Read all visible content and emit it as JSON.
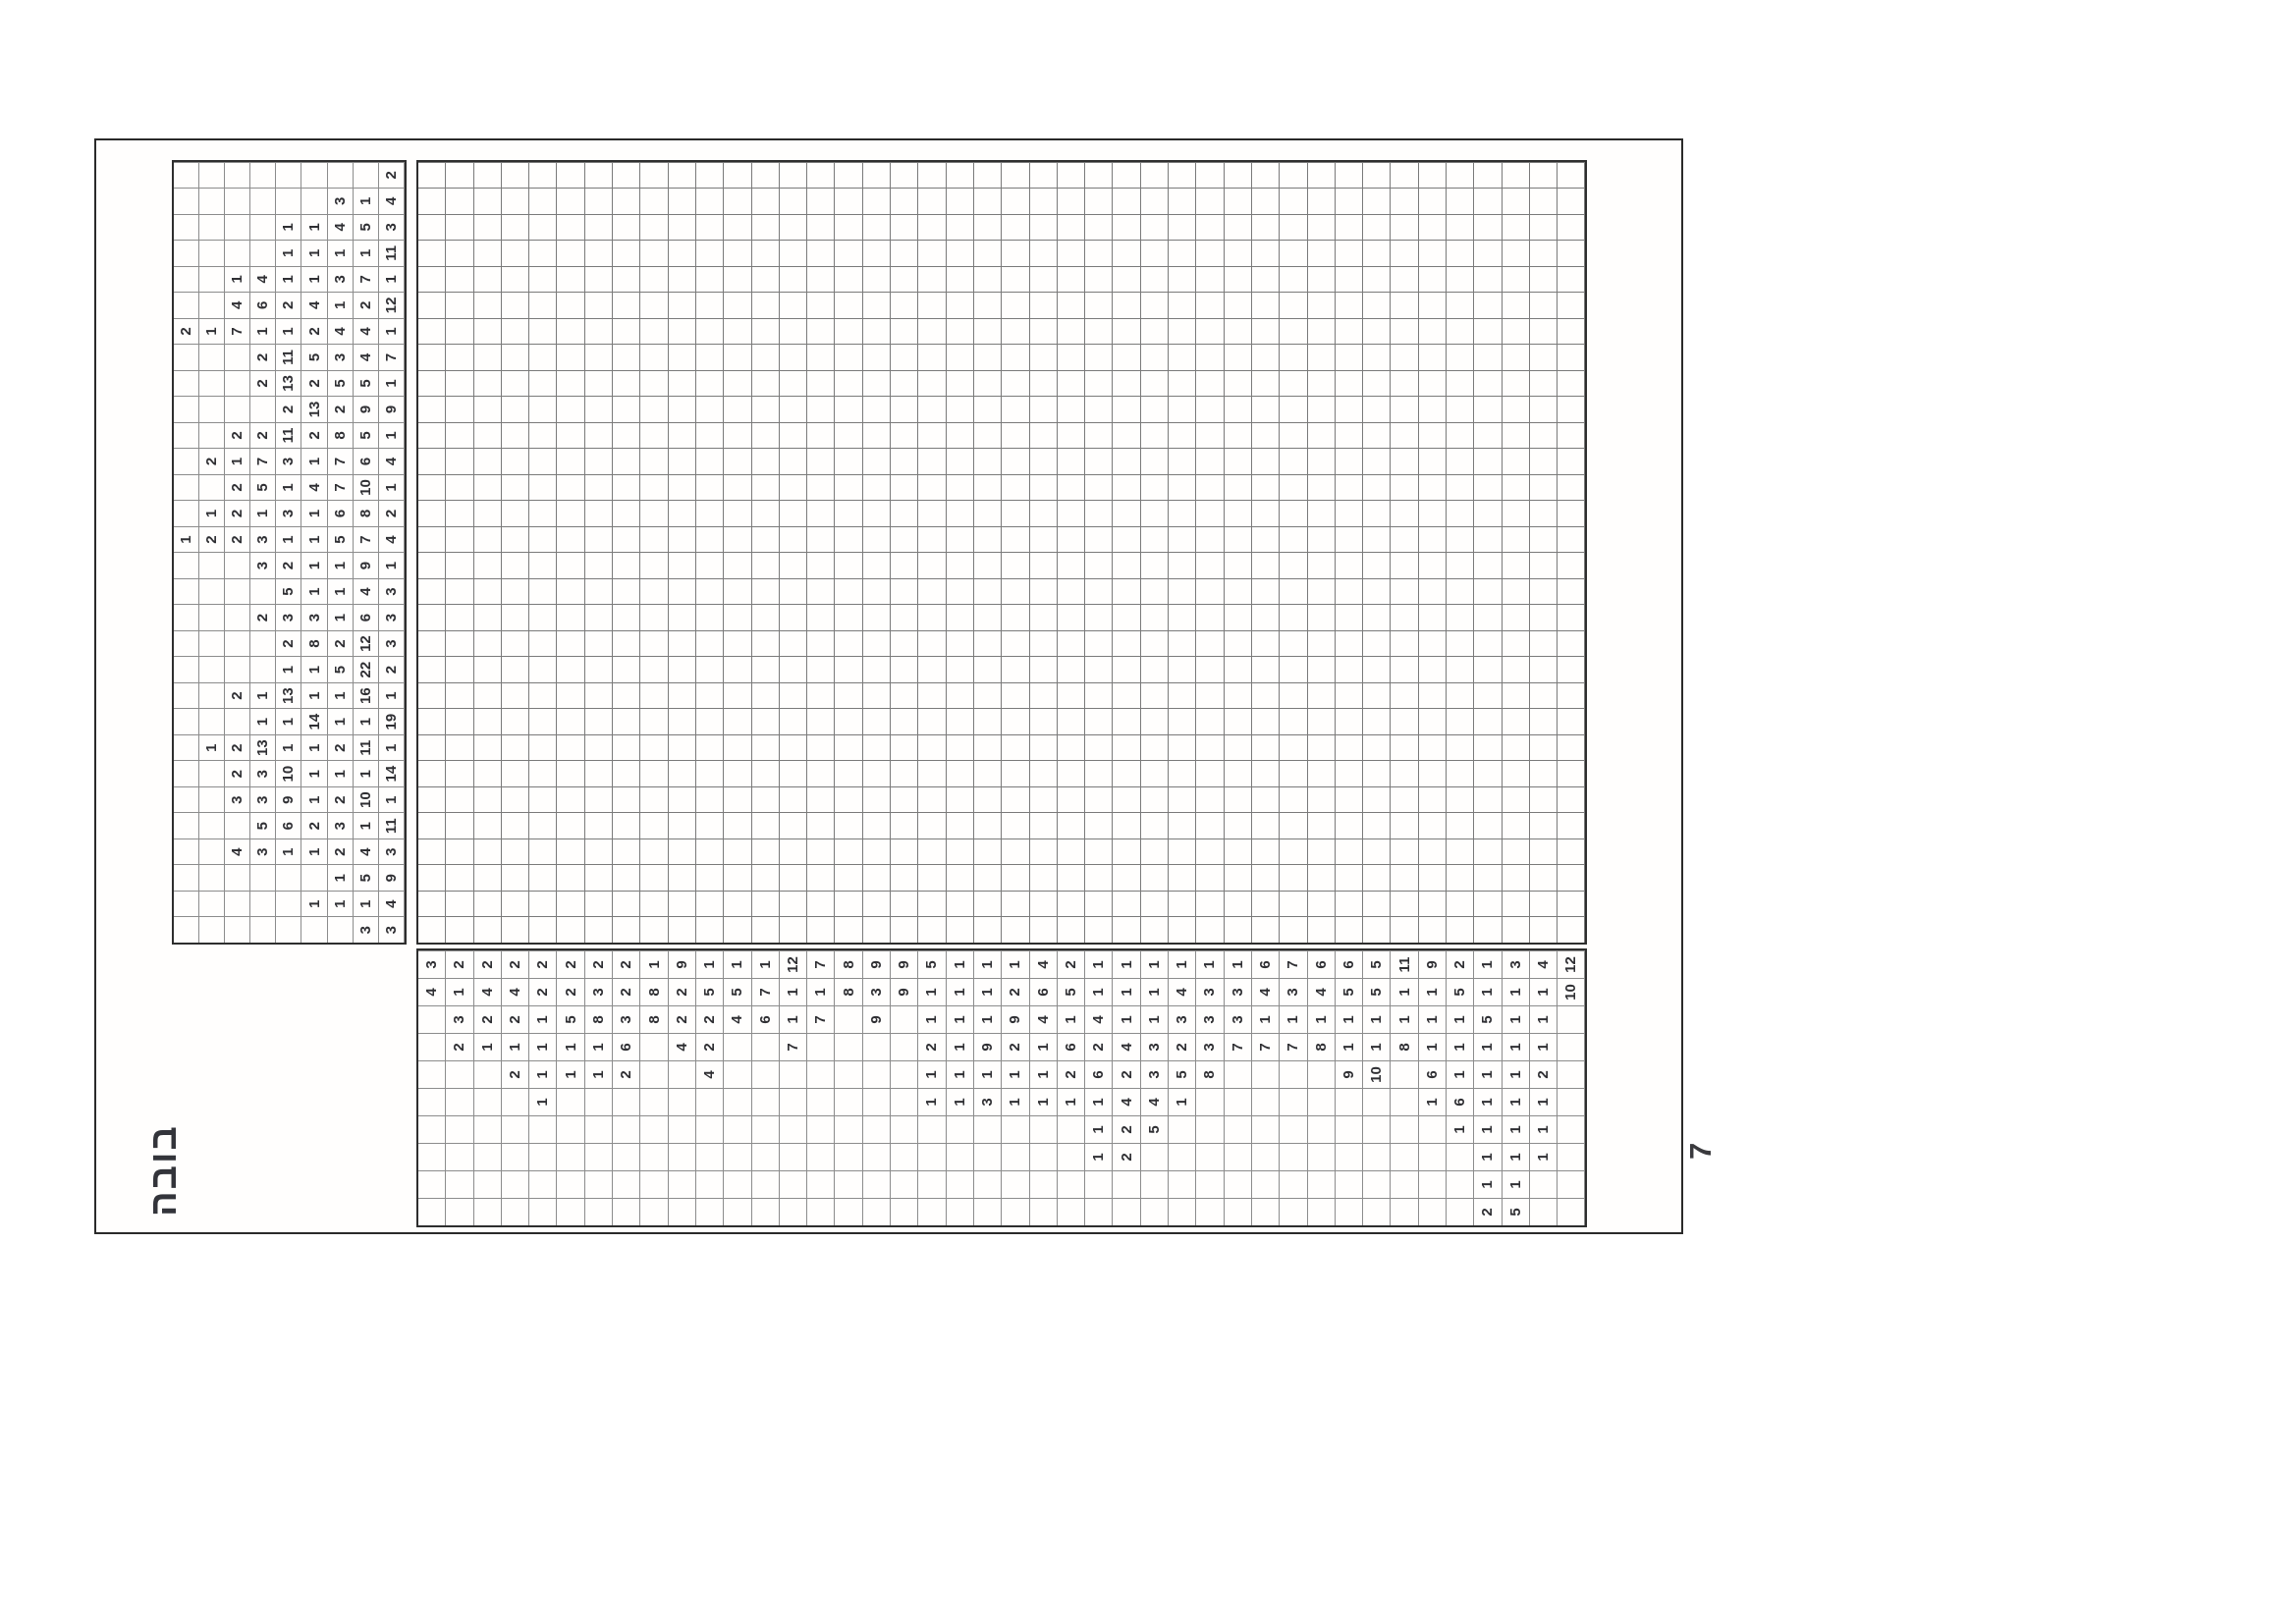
{
  "page": {
    "title": "בובה",
    "page_number": "7"
  },
  "puzzle": {
    "type": "nonogram",
    "grid_columns": 30,
    "grid_rows": 42,
    "column_clue_depth": 9,
    "row_clue_depth": 10,
    "column_clues": [
      [
        3,
        3
      ],
      [
        1,
        1,
        1,
        4
      ],
      [
        1,
        5,
        9
      ],
      [
        4,
        3,
        1,
        1,
        2,
        4,
        3
      ],
      [
        5,
        6,
        2,
        3,
        1,
        11
      ],
      [
        3,
        3,
        9,
        1,
        2,
        10,
        1
      ],
      [
        2,
        3,
        10,
        1,
        1,
        1,
        14
      ],
      [
        1,
        2,
        13,
        1,
        1,
        2,
        11,
        1
      ],
      [
        1,
        1,
        14,
        1,
        1,
        19
      ],
      [
        2,
        1,
        13,
        1,
        1,
        16,
        1
      ],
      [
        1,
        1,
        5,
        22,
        2
      ],
      [
        2,
        8,
        2,
        12,
        3
      ],
      [
        2,
        3,
        3,
        1,
        6,
        3
      ],
      [
        5,
        1,
        1,
        4,
        3
      ],
      [
        3,
        2,
        1,
        1,
        9,
        1
      ],
      [
        1,
        2,
        2,
        3,
        1,
        1,
        5,
        7,
        4
      ],
      [
        1,
        2,
        1,
        3,
        1,
        6,
        8,
        2
      ],
      [
        2,
        5,
        1,
        4,
        7,
        10,
        1
      ],
      [
        2,
        1,
        7,
        3,
        1,
        7,
        6,
        4
      ],
      [
        2,
        2,
        11,
        2,
        8,
        5,
        1
      ],
      [
        2,
        13,
        2,
        9,
        9
      ],
      [
        2,
        13,
        2,
        5,
        5,
        1
      ],
      [
        2,
        11,
        5,
        3,
        4,
        7
      ],
      [
        2,
        1,
        7,
        1,
        1,
        2,
        4,
        4,
        1
      ],
      [
        4,
        6,
        2,
        4,
        1,
        2,
        12
      ],
      [
        1,
        4,
        1,
        1,
        3,
        7,
        1
      ],
      [
        1,
        1,
        1,
        1,
        11
      ],
      [
        1,
        1,
        4,
        5,
        3
      ],
      [
        3,
        1,
        4
      ],
      [
        2
      ]
    ],
    "row_clues": [
      [
        4,
        3
      ],
      [
        2,
        3,
        1,
        2
      ],
      [
        1,
        2,
        4,
        2
      ],
      [
        2,
        1,
        2,
        4,
        2
      ],
      [
        1,
        1,
        1,
        1,
        2,
        2
      ],
      [
        1,
        1,
        5,
        2,
        2
      ],
      [
        1,
        1,
        8,
        3,
        2
      ],
      [
        2,
        6,
        3,
        2,
        2
      ],
      [
        8,
        8,
        1
      ],
      [
        4,
        2,
        2,
        9
      ],
      [
        4,
        2,
        2,
        5,
        1
      ],
      [
        4,
        5,
        1
      ],
      [
        6,
        7,
        1
      ],
      [
        7,
        1,
        1,
        12
      ],
      [
        7,
        1,
        7
      ],
      [
        8,
        8
      ],
      [
        9,
        3,
        9
      ],
      [
        9,
        9
      ],
      [
        1,
        1,
        2,
        1,
        1,
        5
      ],
      [
        1,
        1,
        1,
        1,
        1,
        1
      ],
      [
        3,
        1,
        9,
        1,
        1,
        1
      ],
      [
        1,
        1,
        2,
        9,
        2,
        1
      ],
      [
        1,
        1,
        1,
        4,
        6,
        4
      ],
      [
        1,
        2,
        6,
        1,
        5,
        2
      ],
      [
        1,
        1,
        1,
        6,
        2,
        4,
        1,
        1
      ],
      [
        2,
        2,
        4,
        2,
        4,
        1,
        1,
        1
      ],
      [
        5,
        4,
        3,
        3,
        1,
        1,
        1
      ],
      [
        1,
        5,
        2,
        3,
        4,
        1
      ],
      [
        8,
        3,
        3,
        3,
        1
      ],
      [
        7,
        3,
        3,
        1
      ],
      [
        7,
        1,
        4,
        6
      ],
      [
        7,
        1,
        3,
        7
      ],
      [
        8,
        1,
        4,
        6
      ],
      [
        9,
        1,
        1,
        5,
        6
      ],
      [
        10,
        1,
        1,
        5,
        5
      ],
      [
        8,
        1,
        1,
        11
      ],
      [
        1,
        6,
        1,
        1,
        1,
        9
      ],
      [
        1,
        6,
        1,
        1,
        1,
        5,
        2
      ],
      [
        2,
        1,
        1,
        1,
        1,
        1,
        1,
        5,
        1,
        1
      ],
      [
        5,
        1,
        1,
        1,
        1,
        1,
        1,
        1,
        1,
        3
      ],
      [
        1,
        1,
        1,
        2,
        1,
        1,
        1,
        4
      ],
      [
        10,
        12
      ]
    ]
  },
  "colors": {
    "paper": "#fffefd",
    "frame_line": "#2a2a2a",
    "grid_line": "#8c8c8c",
    "clue_text": "#2f2f33"
  }
}
